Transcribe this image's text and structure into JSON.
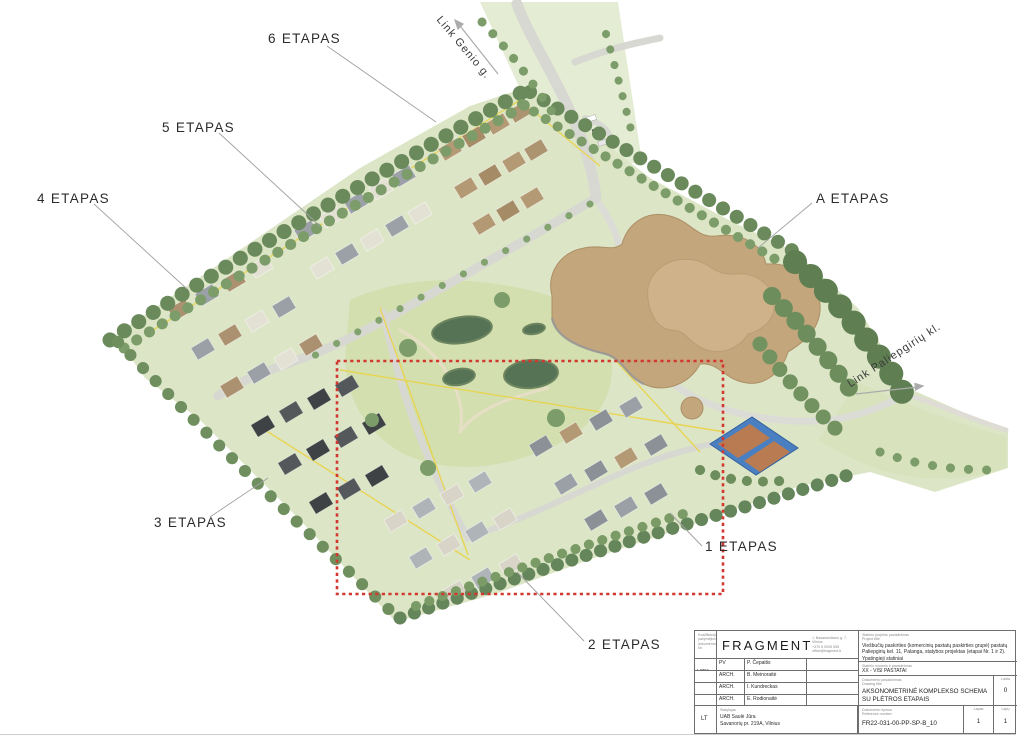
{
  "plan": {
    "phase_labels": [
      {
        "id": "6",
        "text": "6 ETAPAS"
      },
      {
        "id": "5",
        "text": "5 ETAPAS"
      },
      {
        "id": "4",
        "text": "4 ETAPAS"
      },
      {
        "id": "A",
        "text": "A ETAPAS"
      },
      {
        "id": "3",
        "text": "3 ETAPAS"
      },
      {
        "id": "1",
        "text": "1 ETAPAS"
      },
      {
        "id": "2",
        "text": "2 ETAPAS"
      }
    ],
    "street_labels": [
      {
        "text": "Link Genio g."
      },
      {
        "text": "Link Paliepgirių kl."
      }
    ],
    "colors": {
      "boundary_red": "#d23830",
      "utility_yellow": "#e9d44f",
      "water_green": "#567355",
      "building_roof_tan": "#c4a67c"
    }
  },
  "title_block": {
    "cert_label": "Kvalifikacijos pažymėjimo dokumento Nr.",
    "cert_no": "A 2051",
    "logo": "FRAGMENT",
    "contact_lines": [
      "J. Basanavičiaus g. 7, Vilnius",
      "+370 6 9205 555",
      "office@fragment.lt"
    ],
    "rows": [
      {
        "role": "PV",
        "name": "P. Čepaitis"
      },
      {
        "role": "ARCH.",
        "name": "B. Meinoraitė"
      },
      {
        "role": "ARCH.",
        "name": "I. Kundreckas"
      },
      {
        "role": "ARCH.",
        "name": "E. Rodionaitė"
      }
    ],
    "project": {
      "label_lt": "Statinio projekto pavadinimas",
      "label_en": "Project title",
      "value": "Viešbučių paskirties (komercinių pastatų paskirties grupė) pastatų Paliepgirių kel. 11, Palanga, statybos projektas (etapai Nr. 1 ir 2).",
      "note": "Ypatingieji statiniai"
    },
    "building": {
      "label_lt": "Statinio numeris ir pavadinimas",
      "label_en": "Building title",
      "value": "XX - VISI PASTATAI"
    },
    "drawing": {
      "label_lt": "Dokumento pavadinimas",
      "label_en": "Drawing title",
      "value": "AKSONOMETRINĖ KOMPLEKSO SCHEMA SU PLĖTROS ETAPAIS"
    },
    "revision": {
      "label_lt": "Laida",
      "label_en": "Revision",
      "value": "0"
    },
    "reference": {
      "label_lt": "Dokumento žymuo",
      "label_en": "Reference number",
      "value": "FR22-031-00-PP-SP-B_10"
    },
    "sheet": {
      "label_lt": "Lapas",
      "label_en": "Sheet",
      "value": "1"
    },
    "sheets": {
      "label_lt": "Lapų",
      "label_en": "Sheets",
      "value": "1"
    },
    "lang": "LT",
    "client": {
      "label": "Statytojas",
      "line1": "UAB Saulė Jūra",
      "line2": "Savanorių pr. 219A, Vilnius"
    }
  }
}
